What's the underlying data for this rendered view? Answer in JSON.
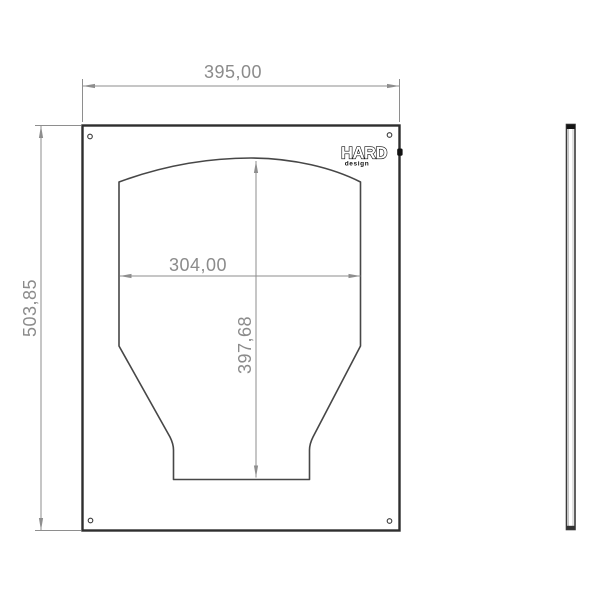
{
  "drawing": {
    "dimensions": {
      "overall_width": "395,00",
      "overall_height": "503,85",
      "cutout_width": "304,00",
      "cutout_height": "397,68"
    },
    "logo": {
      "brand": "HARD",
      "subtext": "design"
    },
    "colors": {
      "edge": "#2e2e2e",
      "thin_edge": "#474747",
      "dimension": "#8e8e8e",
      "background": "#ffffff",
      "logo": "#111111"
    }
  }
}
